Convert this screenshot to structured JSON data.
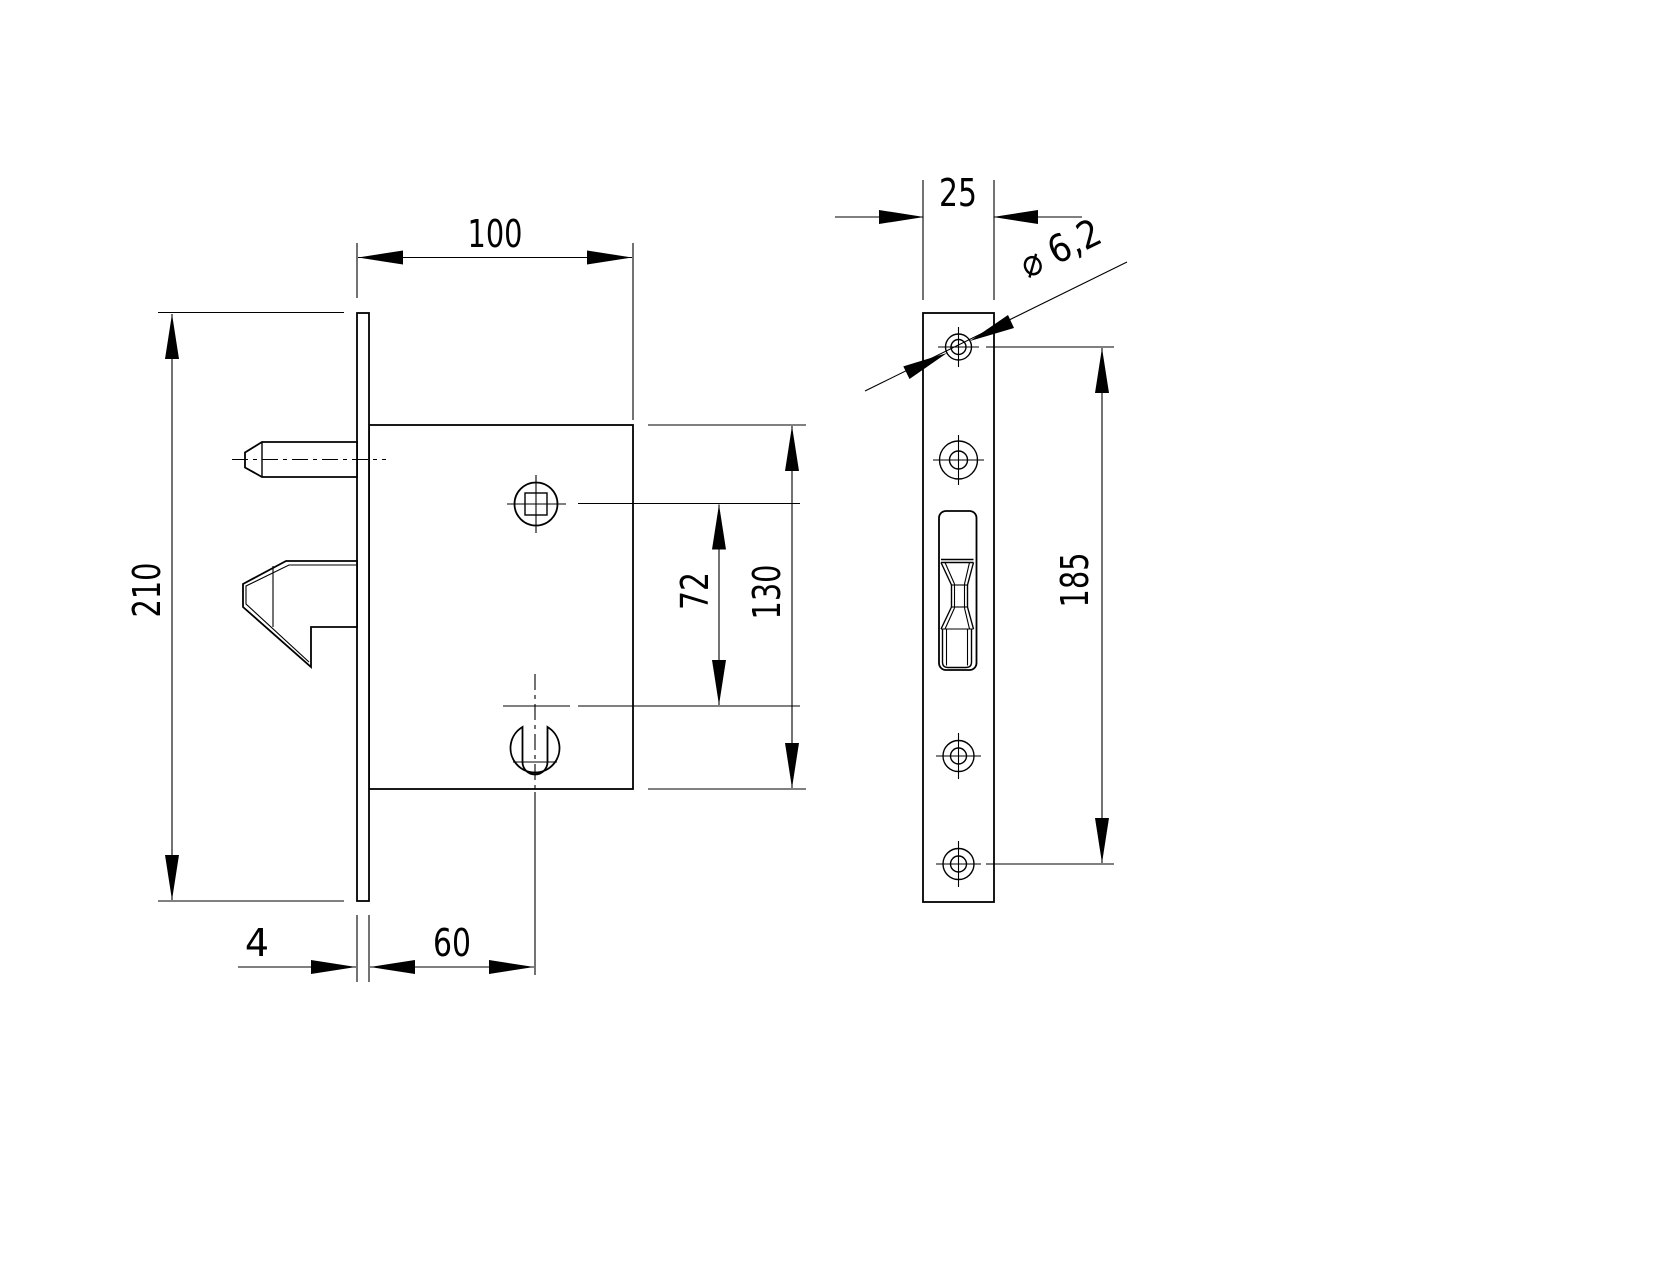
{
  "drawing": {
    "type": "technical-drawing",
    "subject": "hook-bolt mortise lock for sliding door, front view and faceplate edge view",
    "colors": {
      "line": "#000000",
      "background": "#ffffff"
    }
  },
  "dimensions": {
    "case_depth": "100",
    "faceplate_height": "210",
    "hole_spacing": "72",
    "case_height": "130",
    "faceplate_thickness": "4",
    "backset": "60",
    "faceplate_width": "25",
    "screw_spacing": "185",
    "hole_diameter": "⌀ 6,2"
  }
}
